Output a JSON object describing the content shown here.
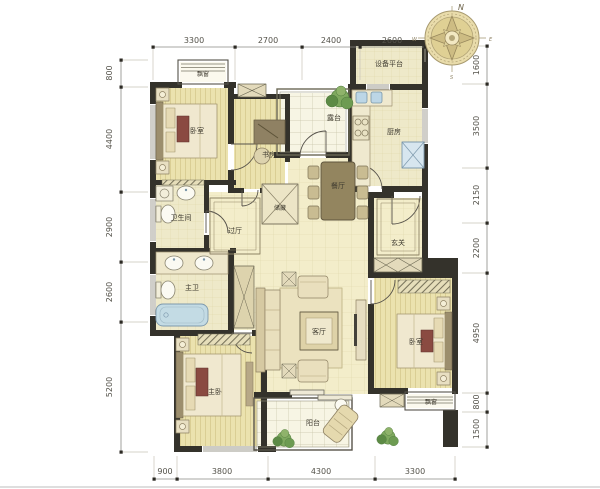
{
  "rooms": [
    {
      "id": "bay-window-top",
      "label": "飘窗"
    },
    {
      "id": "bedroom-1",
      "label": "卧室"
    },
    {
      "id": "study",
      "label": "书房"
    },
    {
      "id": "equipment-platform",
      "label": "设备平台"
    },
    {
      "id": "terrace",
      "label": "露台"
    },
    {
      "id": "kitchen",
      "label": "厨房"
    },
    {
      "id": "dining-room",
      "label": "餐厅"
    },
    {
      "id": "foyer",
      "label": "玄关"
    },
    {
      "id": "bathroom",
      "label": "卫生间"
    },
    {
      "id": "hallway",
      "label": "过厅"
    },
    {
      "id": "storage",
      "label": "储藏"
    },
    {
      "id": "master-bathroom",
      "label": "主卫"
    },
    {
      "id": "master-bedroom",
      "label": "主卧"
    },
    {
      "id": "living-room",
      "label": "客厅"
    },
    {
      "id": "bedroom-2",
      "label": "卧室"
    },
    {
      "id": "bay-window-bottom",
      "label": "飘窗"
    },
    {
      "id": "balcony",
      "label": "阳台"
    }
  ],
  "dimensions": {
    "top": [
      "3300",
      "2700",
      "2400",
      "2600"
    ],
    "left": [
      "800",
      "4400",
      "2900",
      "2600",
      "5200"
    ],
    "right": [
      "1600",
      "3500",
      "2150",
      "2200",
      "4950",
      "800",
      "1500"
    ],
    "bottom": [
      "900",
      "3800",
      "4300",
      "3300"
    ]
  },
  "compass": {
    "north": "N",
    "east": "E",
    "west": "W",
    "south": "S"
  },
  "colors": {
    "wall": "#34322b",
    "wood_floor": "#ebe2ae",
    "tile_floor": "#f3edca",
    "fixture_blue": "#c3dbe4",
    "plant_green": "#6d9b52",
    "dimension_text": "#54524a"
  }
}
